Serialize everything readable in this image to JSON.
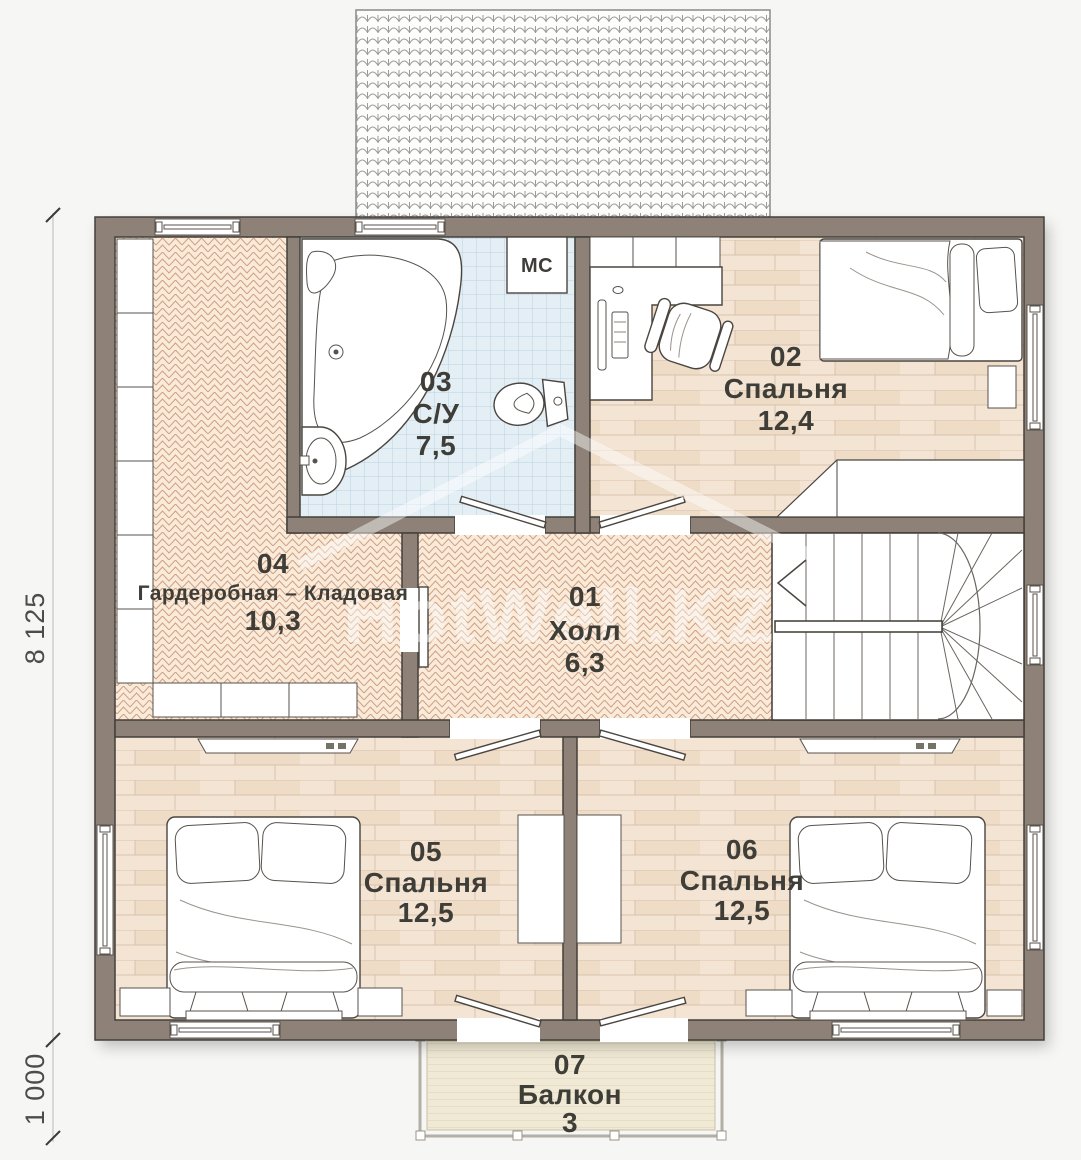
{
  "plan": {
    "watermark": "HotWell.KZ",
    "dimensions": {
      "total_depth": "8 125",
      "balcony_depth": "1 000"
    },
    "washer_label": "МС",
    "rooms": [
      {
        "number": "01",
        "name": "Холл",
        "area": "6,3"
      },
      {
        "number": "02",
        "name": "Спальня",
        "area": "12,4"
      },
      {
        "number": "03",
        "name": "С/У",
        "area": "7,5"
      },
      {
        "number": "04",
        "name": "Гардеробная – Кладовая",
        "area": "10,3"
      },
      {
        "number": "05",
        "name": "Спальня",
        "area": "12,5"
      },
      {
        "number": "06",
        "name": "Спальня",
        "area": "12,5"
      },
      {
        "number": "07",
        "name": "Балкон",
        "area": "3"
      }
    ],
    "colors": {
      "wall": "#8d8178",
      "floor_plank": "#f3e4d4",
      "floor_herringbone": "#f9ead9",
      "floor_tile": "#e3eef5",
      "deck": "#f0e9d5"
    }
  }
}
